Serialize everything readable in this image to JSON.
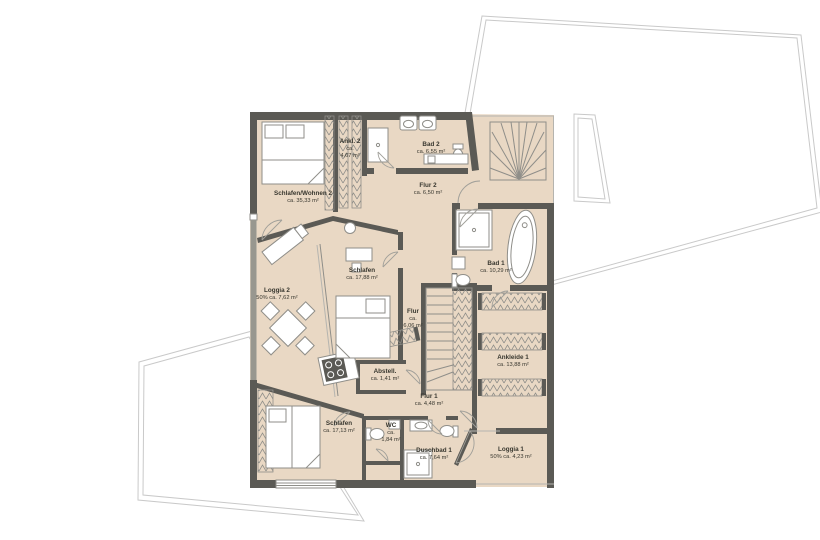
{
  "colors": {
    "floor": "#e9d8c4",
    "wall": "#5b5a55",
    "wallmid": "#98978f",
    "line": "#8f8e89",
    "outline": "#c9c9c9",
    "text": "#38372f"
  },
  "rooms": [
    {
      "id": "schlafen-wohnen-2",
      "name": "Schlafen/Wohnen 2",
      "area_lines": [
        "ca. 35,33 m²"
      ],
      "x": 303,
      "y": 195
    },
    {
      "id": "ankl-2",
      "name": "Ankl. 2",
      "area_lines": [
        "ca.",
        "4,67 m²"
      ],
      "x": 350,
      "y": 143
    },
    {
      "id": "bad-2",
      "name": "Bad 2",
      "area_lines": [
        "ca. 6,55 m²"
      ],
      "x": 431,
      "y": 146
    },
    {
      "id": "flur-2",
      "name": "Flur 2",
      "area_lines": [
        "ca. 6,50 m²"
      ],
      "x": 428,
      "y": 187
    },
    {
      "id": "bad-1",
      "name": "Bad 1",
      "area_lines": [
        "ca. 10,29 m²"
      ],
      "x": 496,
      "y": 265
    },
    {
      "id": "schlafen-mitte",
      "name": "Schlafen",
      "area_lines": [
        "ca. 17,88 m²"
      ],
      "x": 362,
      "y": 272
    },
    {
      "id": "loggia-2",
      "name": "Loggia 2",
      "area_lines": [
        "50% ca. 7,62 m²"
      ],
      "x": 277,
      "y": 292
    },
    {
      "id": "flur",
      "name": "Flur",
      "area_lines": [
        "ca.",
        "6,06 m²"
      ],
      "x": 413,
      "y": 313
    },
    {
      "id": "ankleide-1",
      "name": "Ankleide 1",
      "area_lines": [
        "ca. 13,88 m²"
      ],
      "x": 513,
      "y": 359
    },
    {
      "id": "abstell",
      "name": "Abstell.",
      "area_lines": [
        "ca. 1,41 m²"
      ],
      "x": 385,
      "y": 373
    },
    {
      "id": "flur-1",
      "name": "Flur 1",
      "area_lines": [
        "ca. 4,48 m²"
      ],
      "x": 429,
      "y": 398
    },
    {
      "id": "schlafen-unten",
      "name": "Schlafen",
      "area_lines": [
        "ca. 17,13 m²"
      ],
      "x": 339,
      "y": 425
    },
    {
      "id": "wc",
      "name": "WC",
      "area_lines": [
        "ca.",
        "1,84 m²"
      ],
      "x": 391,
      "y": 427
    },
    {
      "id": "duschbad-1",
      "name": "Duschbad 1",
      "area_lines": [
        "ca. 7,64 m²"
      ],
      "x": 434,
      "y": 452
    },
    {
      "id": "loggia-1",
      "name": "Loggia 1",
      "area_lines": [
        "50% ca. 4,23 m²"
      ],
      "x": 511,
      "y": 451
    }
  ]
}
